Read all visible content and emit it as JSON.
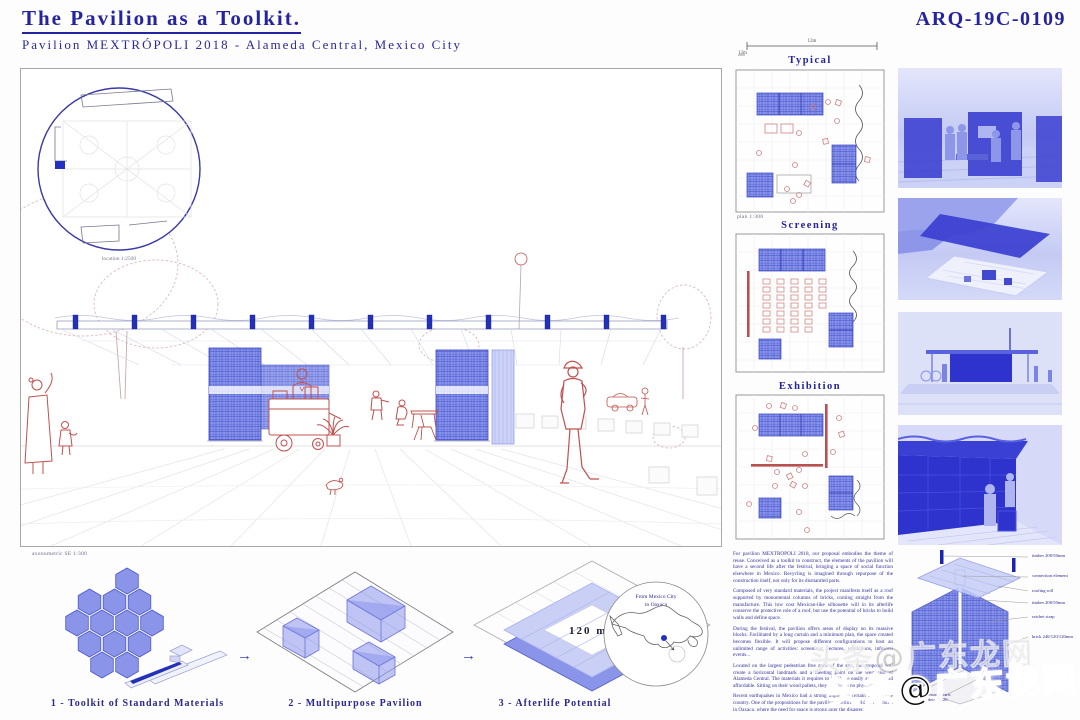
{
  "header": {
    "title": "The Pavilion as a Toolkit.",
    "subtitle": "Pavilion MEXTRÓPOLI 2018 - Alameda Central, Mexico City",
    "code": "ARQ-19C-0109"
  },
  "main_drawing": {
    "location_caption": "location 1:2500"
  },
  "plans": {
    "scale_h": "12m",
    "scale_v": "12m",
    "typical": {
      "title": "Typical",
      "caption": "plan 1:300"
    },
    "screening": {
      "title": "Screening"
    },
    "exhibition": {
      "title": "Exhibition"
    }
  },
  "process": {
    "axo_caption": "axonometric SE 1:300",
    "arrow": "→",
    "area_label": "120 m2",
    "steps": [
      {
        "label": "1 - Toolkit of Standard Materials"
      },
      {
        "label": "2 - Multipurpose Pavilion"
      },
      {
        "label": "3 - Afterlife Potential"
      }
    ],
    "map": {
      "line1": "From Mexico City",
      "line2": "to Oaxaca"
    }
  },
  "description": {
    "paragraphs": [
      "For pavilion MEXTRÓPOLI 2018, our proposal embodies the theme of reuse. Conceived as a toolkit to construct, the elements of the pavilion will have a second life after the festival, bringing a space of social function elsewhere in Mexico. Recycling is imagined through repurpose of the construction itself, not only for its dismantled parts.",
      "Composed of very standard materials, the project manifests itself as a roof supported by monumental columns of bricks, coming straight from the manufacture. This low cost Mexican-like silhouette will in its afterlife conserve the protective role of a roof, but use the potential of bricks to build walls and define space.",
      "During the festival, the pavilion offers areas of display on its massive blocks. Facilitated by a long curtain and a minimum plan, the space created becomes flexible. It will propose different configurations to host an unlimited range of activities: screenings, lectures, exhibitions, informal events...",
      "Located on the largest pedestrian free zone of the site, the proposal will create a horizontal landmark and a meeting point on the west side of Alameda Central. The materials it requires to build are easily available and affordable. Sitting on their wood pallets, they will leave no physical trace.",
      "Recent earthquakes in Mexico had a strong impact on certain areas of the country. One of the propositions for the pavilion afterlife could be to rebuild in Oaxaca, where the need for space is strong after the disaster."
    ],
    "closing": "An ephemeral cultural venue becomes therefore a permanent donation."
  },
  "detail": {
    "labels": [
      "timber 200/50mm",
      "connection element",
      "roofing roll",
      "timber 200/50mm",
      "ratchet strap",
      "brick 240/120/120mm"
    ],
    "caption_line1": "axonometric",
    "caption_line2": "detail 1:20"
  },
  "watermark": {
    "text": "头条@广东龙网"
  },
  "colors": {
    "navy": "#2424a0",
    "brick_blue": "#8a94e8",
    "light_blue": "#c9cff5",
    "red_line": "#c0504d",
    "photo_blue": "#2d33cc"
  }
}
